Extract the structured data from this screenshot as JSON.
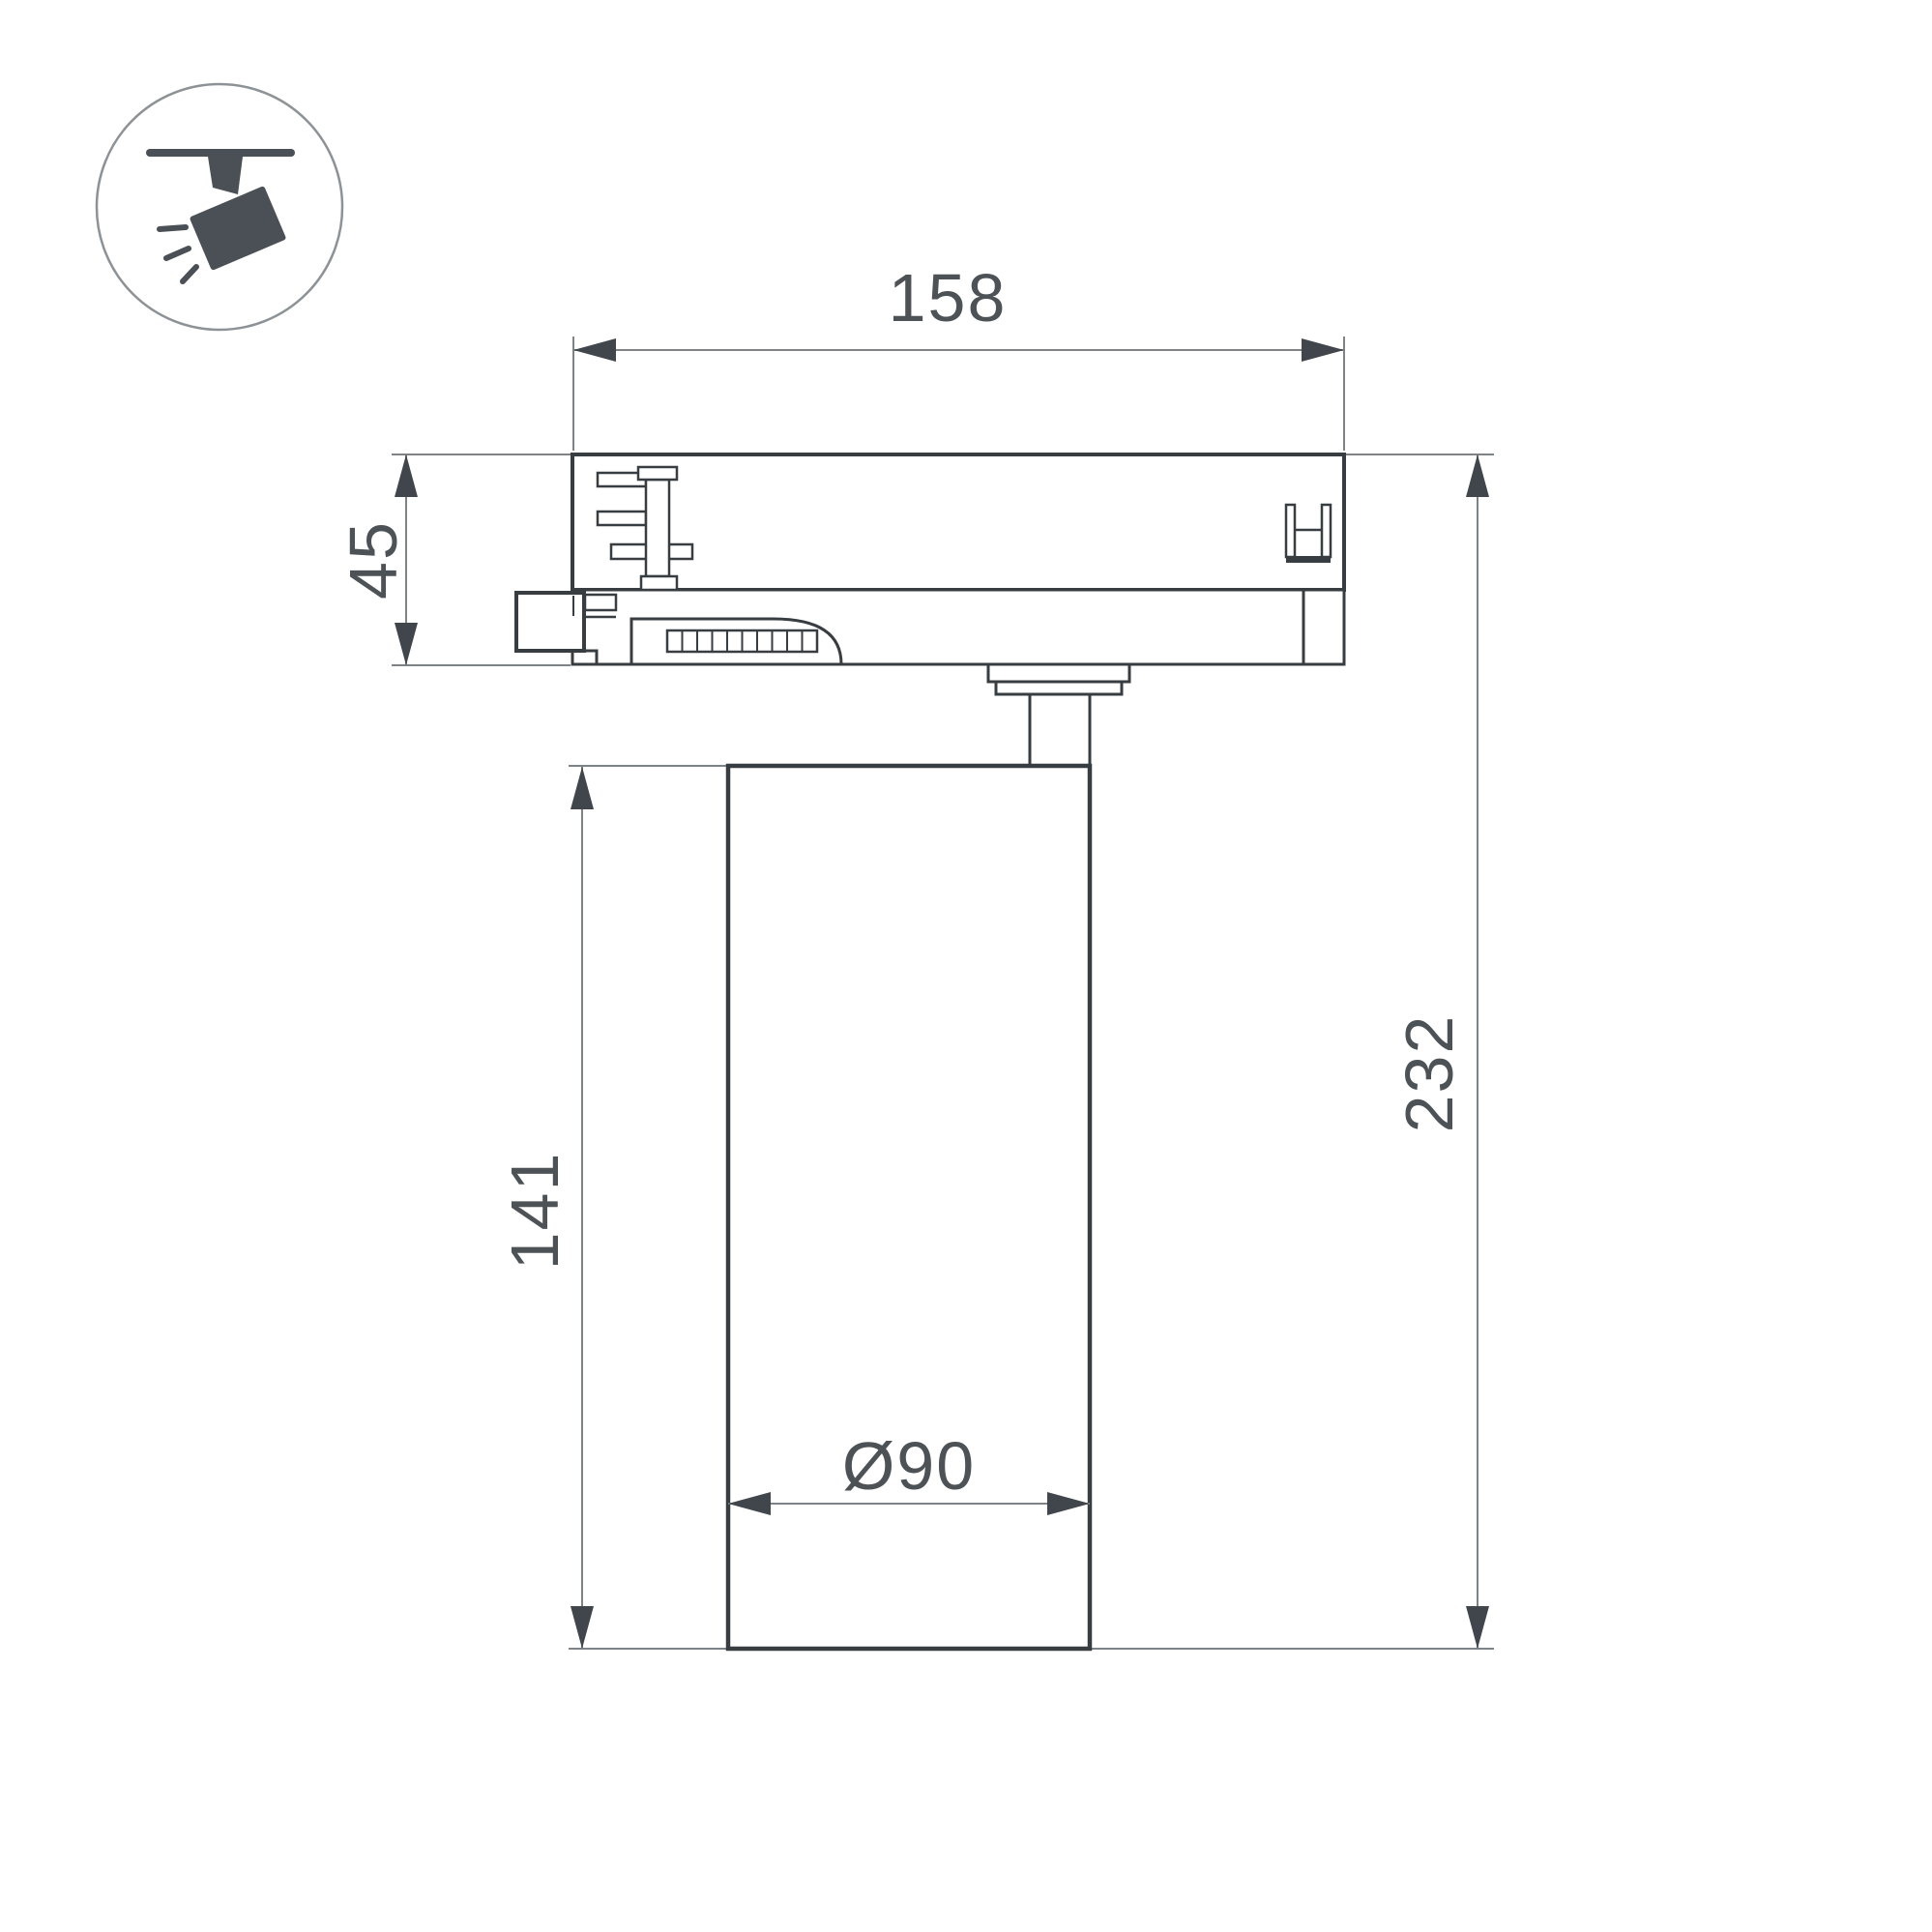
{
  "drawing": {
    "type": "track-spotlight dimension drawing",
    "icon": "track-spotlight-icon"
  },
  "dims": {
    "adapter_width": {
      "value": "158"
    },
    "adapter_height": {
      "value": "45"
    },
    "body_height": {
      "value": "141"
    },
    "total_height": {
      "value": "232"
    },
    "body_diameter": {
      "value": "Ø90"
    }
  },
  "colors": {
    "outline": "#383d42",
    "thin_line": "#7e8387",
    "text": "#4d5257",
    "icon": "#4a5056",
    "icon_circle": "#8d9296",
    "background": "#ffffff"
  }
}
